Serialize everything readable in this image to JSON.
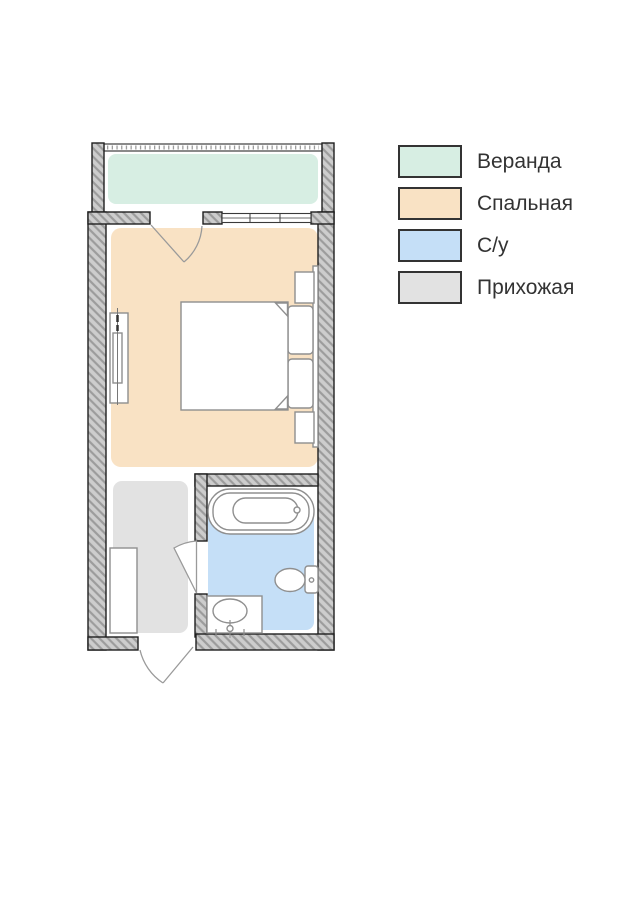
{
  "rooms": {
    "veranda": {
      "label": "Веранда",
      "color": "#d7eee3"
    },
    "bedroom": {
      "label": "Спальная",
      "color": "#f9e2c4"
    },
    "bathroom": {
      "label": "С/у",
      "color": "#c5dff7"
    },
    "hallway": {
      "label": "Прихожая",
      "color": "#e2e2e2"
    }
  },
  "legend": {
    "order": [
      "veranda",
      "bedroom",
      "bathroom",
      "hallway"
    ]
  },
  "plan": {
    "type": "floor-plan",
    "fixtures": [
      "double-bed",
      "pillow",
      "pillow",
      "nightstand",
      "nightstand",
      "headboard-panel",
      "tv-stand",
      "wardrobe",
      "bathtub",
      "toilet",
      "washbasin"
    ],
    "openings": [
      "veranda-door",
      "window",
      "bathroom-door",
      "entrance-door"
    ]
  },
  "colors": {
    "wall_fill": "#cdcdcd",
    "wall_hatch": "#9c9c9c",
    "wall_outline": "#1f1f1f",
    "furniture_stroke": "#8f8f8f",
    "door_stroke": "#9a9a9a",
    "rail_stroke": "#2a2a2a",
    "window_stroke": "#3a3a3a",
    "text": "#333333"
  }
}
